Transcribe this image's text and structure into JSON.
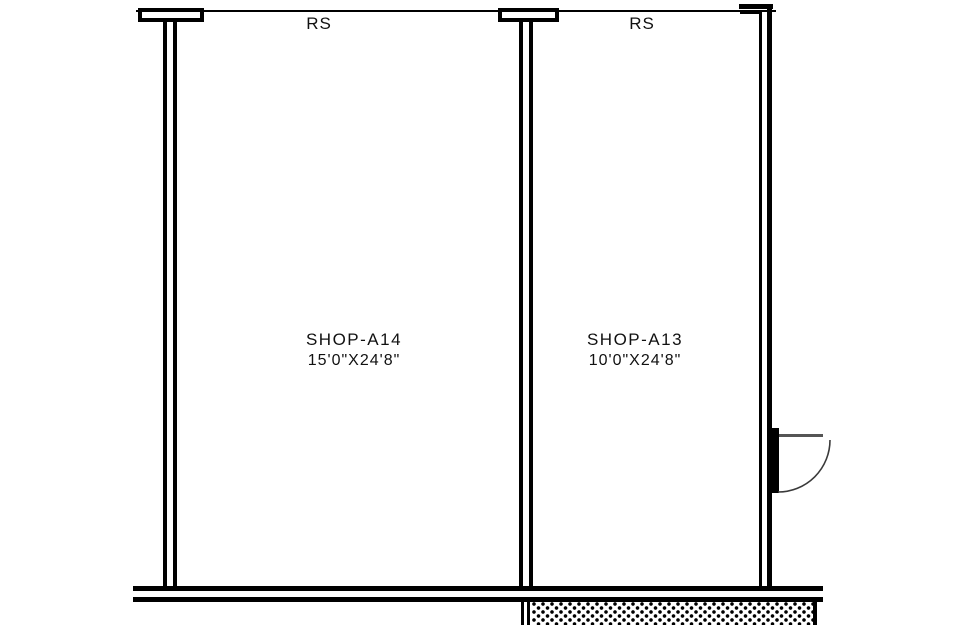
{
  "drawing": {
    "title": "shop floor plan section",
    "colors": {
      "ink": "#000000",
      "paper": "#ffffff",
      "door_panel": "#555555",
      "door_swing": "#3a3a3a",
      "text": "#111111"
    },
    "rooms": [
      {
        "rs_label": "RS",
        "name": "SHOP-A14",
        "dimensions": "15'0\"X24'8\""
      },
      {
        "rs_label": "RS",
        "name": "SHOP-A13",
        "dimensions": "10'0\"X24'8\""
      }
    ]
  }
}
